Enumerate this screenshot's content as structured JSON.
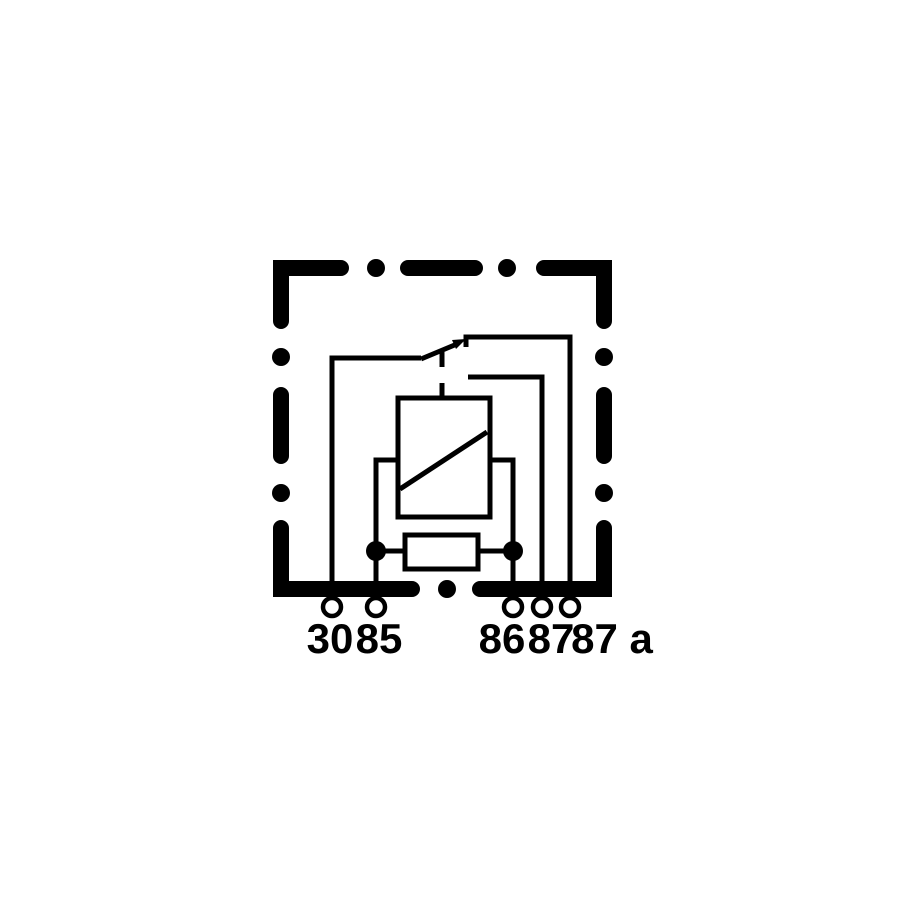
{
  "page": {
    "background": "#ffffff"
  },
  "diagram": {
    "kind": "relay-wiring-schematic",
    "ink_color": "#000000",
    "background_color": "#ffffff",
    "components": {
      "housing": "dash-dot-outline-box",
      "coil": "relay-coil-rectangle-with-diagonal",
      "resistor": "resistor-box-parallel-to-coil",
      "switch": "changeover-contact-with-arrow"
    },
    "terminals": [
      {
        "label": "30"
      },
      {
        "label": "85"
      },
      {
        "label": "86"
      },
      {
        "label": "87"
      },
      {
        "label": "87 a"
      }
    ]
  }
}
